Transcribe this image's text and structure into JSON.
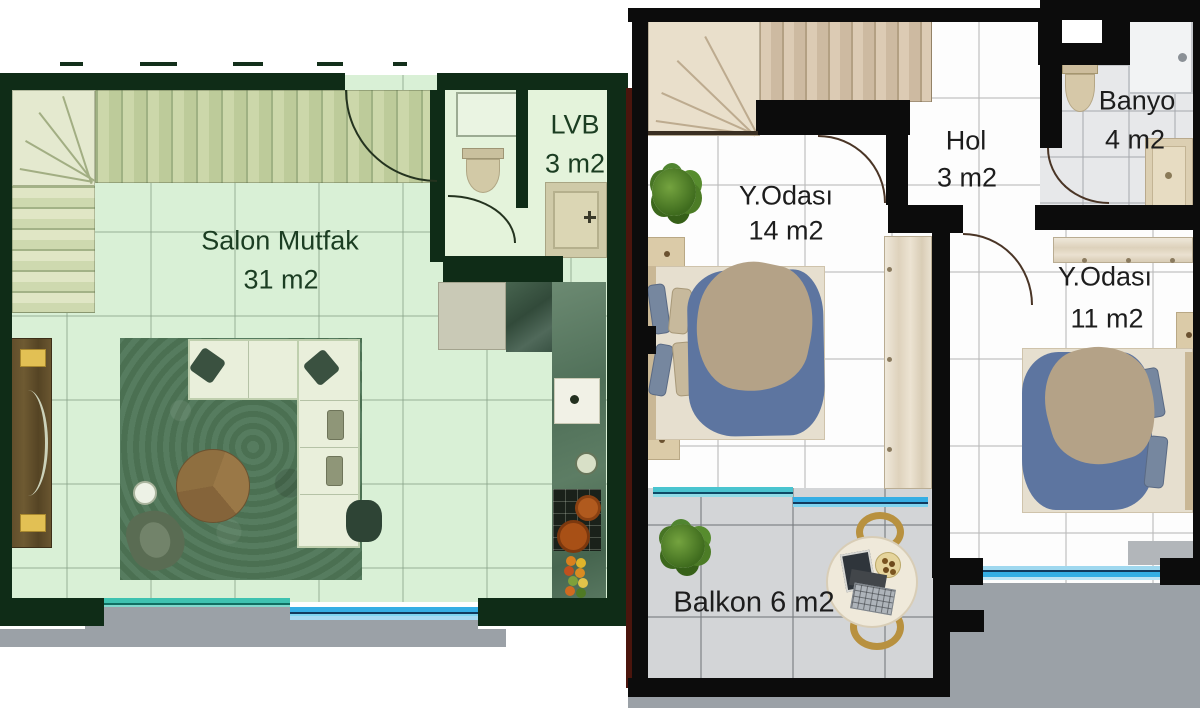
{
  "plans": {
    "lower": {
      "rooms": {
        "salon": {
          "label": "Salon Mutfak",
          "area": "31 m2"
        },
        "lvb": {
          "label": "LVB",
          "area": "3 m2"
        }
      }
    },
    "upper": {
      "rooms": {
        "bedroom_14": {
          "label": "Y.Odası",
          "area": "14 m2"
        },
        "hol": {
          "label": "Hol",
          "area": "3 m2"
        },
        "banyo": {
          "label": "Banyo",
          "area": "4 m2"
        },
        "bedroom_11": {
          "label": "Y.Odası",
          "area": "11 m2"
        },
        "balkon": {
          "label": "Balkon",
          "area": "6 m2"
        }
      }
    }
  },
  "colors": {
    "lower_wall": "#0f2c17",
    "lower_floor": "#d9f0d6",
    "lower_text": "#1b3d22",
    "upper_wall": "#0c0c0c",
    "upper_floor": "#fdfdfd",
    "upper_text": "#1d1d1d",
    "window_teal": "#2cb6a3",
    "window_blue": "#2f9fdd",
    "balcony_floor": "#d3d5d7",
    "outside_grey": "#9ba1a7",
    "stairs_lower": "#ccd7aa",
    "stairs_upper": "#dccbb4",
    "rug_green": "#527758",
    "duvet_blue": "#5d75a0",
    "blanket_beige": "#b4a287",
    "edge_maroon": "#4b150d"
  }
}
